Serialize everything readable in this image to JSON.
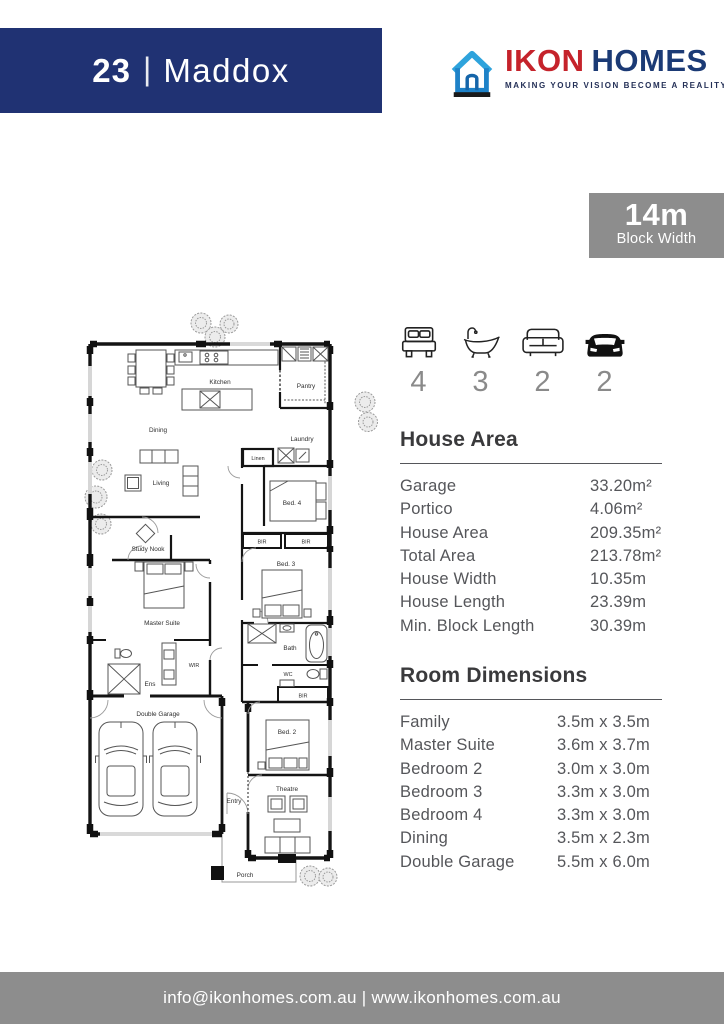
{
  "header": {
    "number": "23",
    "separator": "|",
    "name": "Maddox"
  },
  "logo": {
    "ikon": "IKON",
    "homes": "HOMES",
    "tagline": "MAKING YOUR VISION BECOME A REALITY"
  },
  "badge": {
    "value": "14m",
    "label": "Block Width"
  },
  "stats": {
    "beds": "4",
    "baths": "3",
    "living": "2",
    "cars": "2"
  },
  "house_area": {
    "title": "House Area",
    "rows": [
      {
        "label": "Garage",
        "value": "33.20m²"
      },
      {
        "label": "Portico",
        "value": "4.06m²"
      },
      {
        "label": "House Area",
        "value": "209.35m²"
      },
      {
        "label": "Total Area",
        "value": "213.78m²"
      },
      {
        "label": "House Width",
        "value": "10.35m"
      },
      {
        "label": "House Length",
        "value": "23.39m"
      },
      {
        "label": "Min. Block Length",
        "value": "30.39m"
      }
    ]
  },
  "room_dimensions": {
    "title": "Room Dimensions",
    "rows": [
      {
        "label": "Family",
        "value": "3.5m x 3.5m"
      },
      {
        "label": "Master Suite",
        "value": "3.6m x 3.7m"
      },
      {
        "label": "Bedroom 2",
        "value": "3.0m x 3.0m"
      },
      {
        "label": "Bedroom 3",
        "value": "3.3m x 3.0m"
      },
      {
        "label": "Bedroom 4",
        "value": "3.3m x 3.0m"
      },
      {
        "label": "Dining",
        "value": "3.5m x 2.3m"
      },
      {
        "label": "Double Garage",
        "value": "5.5m x 6.0m"
      }
    ]
  },
  "plan": {
    "kitchen": "Kitchen",
    "pantry": "Pantry",
    "dining": "Dining",
    "living": "Living",
    "laundry": "Laundry",
    "linen": "Linen",
    "bed4": "Bed. 4",
    "study_nook": "Study Nook",
    "bir": "BIR",
    "bed3": "Bed. 3",
    "master_suite": "Master Suite",
    "bath": "Bath",
    "wir": "WIR",
    "ens": "Ens",
    "wc": "WC",
    "double_garage": "Double Garage",
    "bed2": "Bed. 2",
    "entry": "Entry",
    "theatre": "Theatre",
    "porch": "Porch"
  },
  "footer": {
    "text": "info@ikonhomes.com.au | www.ikonhomes.com.au"
  },
  "colors": {
    "navy": "#203273",
    "red": "#c5232b",
    "light_blue": "#2ea3dc",
    "gray": "#8d8d8d",
    "heading_text": "#3a3a3c",
    "body_text": "#55565a"
  }
}
